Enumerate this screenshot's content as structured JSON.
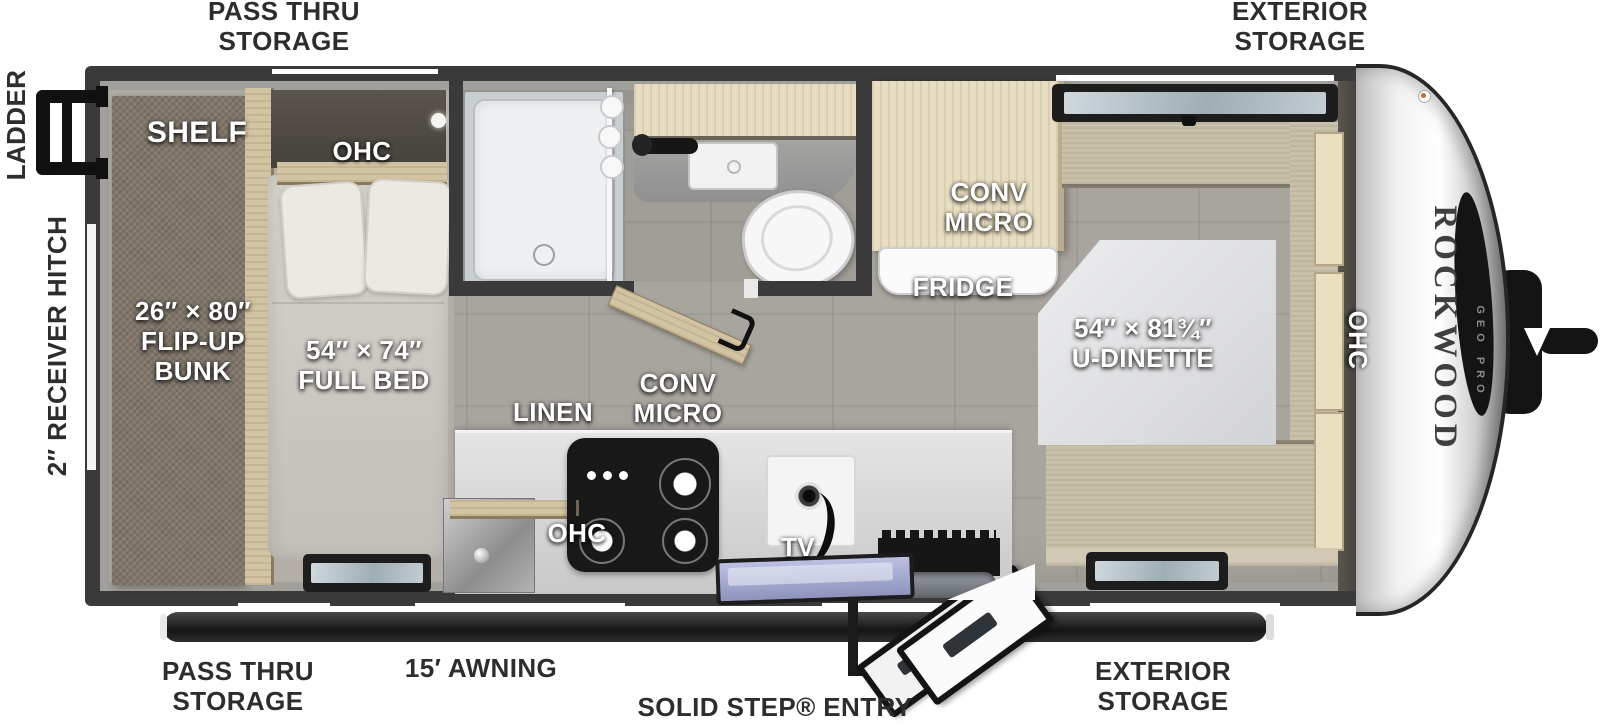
{
  "title": "Rockwood Geo Pro travel trailer floor plan",
  "exterior_callouts": {
    "pass_thru_top": "PASS THRU\nSTORAGE",
    "exterior_storage_top": "EXTERIOR\nSTORAGE",
    "ladder": "LADDER",
    "receiver_hitch": "2″ RECEIVER HITCH",
    "pass_thru_bottom": "PASS THRU\nSTORAGE",
    "awning": "15′ AWNING",
    "solid_step_entry": "SOLID STEP® ENTRY",
    "exterior_storage_bottom": "EXTERIOR\nSTORAGE"
  },
  "interior_callouts": {
    "shelf": "SHELF",
    "ohc_bedroom": "OHC",
    "flip_up_bunk": "26″ × 80″\nFLIP-UP\nBUNK",
    "full_bed": "54″ × 74″\nFULL BED",
    "linen": "LINEN",
    "conv_micro_kitchen": "CONV\nMICRO",
    "ohc_kitchen": "OHC",
    "tv": "TV",
    "conv_micro_fridge": "CONV\nMICRO",
    "fridge": "FRIDGE",
    "u_dinette": "54″ × 81¾″\nU-DINETTE",
    "ohc_dinette": "OHC"
  },
  "branding": {
    "model": "ROCKWOOD",
    "series": "GEO PRO"
  },
  "colors": {
    "wall": "#3a3a3a",
    "floor_tile": "#a8a49e",
    "bedroom_floor": "#b3aea6",
    "bench_fabric": "#c9c0aa",
    "cabinet_wood": "#e7ddc2",
    "awning_bar": "#1e1e1e",
    "callout_dark": "#2d2d2d",
    "callout_light": "#ffffff"
  }
}
